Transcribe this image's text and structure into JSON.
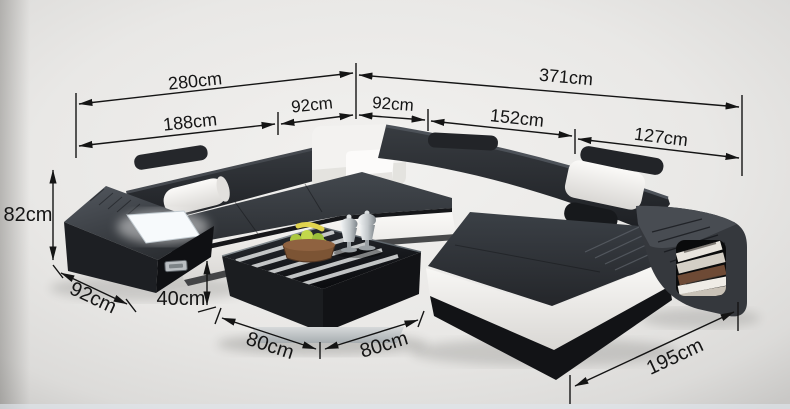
{
  "meta": {
    "description": "Black and white leather U-shaped sectional sofa with chaise, storage arms and square glass coffee table, annotated with product dimensions",
    "unit": "cm"
  },
  "style": {
    "background": "#e9e8e6",
    "annotation_color": "#141414",
    "sofa_black": "#26282c",
    "sofa_white": "#f3f2f0",
    "table_glass": "#141619",
    "plinth_silver": "#c3c7c9"
  },
  "dimensions": {
    "top_total_left": "280cm",
    "top_total_right": "371cm",
    "upper_left_section": "188cm",
    "upper_corner_left": "92cm",
    "upper_corner_right": "92cm",
    "upper_right_section": "152cm",
    "upper_right_end": "127cm",
    "back_height": "82cm",
    "arm_depth": "92cm",
    "table_height": "40cm",
    "table_side_left": "80cm",
    "table_side_right": "80cm",
    "chaise_length": "195cm"
  }
}
